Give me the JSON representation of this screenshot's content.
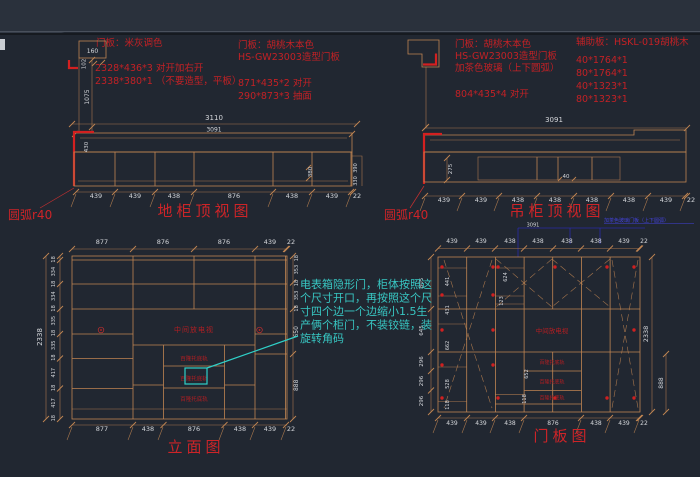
{
  "colors": {
    "background": "#212731",
    "topbar": "#2a313c",
    "line_tan": "#c08552",
    "red": "#c42125",
    "dim_text": "#d5d7db",
    "cyan": "#38c7c3",
    "blue_watermark": "#4343dc"
  },
  "notes": {
    "left": {
      "l1": "门板：米灰调色",
      "l2": "2328*436*3  对开加右开",
      "l3": "2338*380*1 （不要造型，平板）"
    },
    "mid": {
      "l1": "门板：胡桃木本色",
      "l2": "HS-GW23003造型门板",
      "l3": "871*435*2  对开",
      "l4": "290*873*3  抽面"
    },
    "right": {
      "l1": "门板：胡桃木本色",
      "l2": "HS-GW23003造型门板",
      "l3": "加茶色玻璃（上下圆弧）",
      "l4": "804*435*4  对开"
    },
    "aux": {
      "title": "辅助板：HSKL-019胡桃木",
      "i1": "40*1764*1",
      "i2": "80*1764*1",
      "i3": "40*1323*1",
      "i4": "80*1323*1"
    }
  },
  "base_top": {
    "title": "地柜顶视图",
    "arc_label": "圆弧r40",
    "dim_total": "3110",
    "dim_inner": "3091",
    "dim_depth": "430",
    "dim_380": "380",
    "dim_390": "390",
    "dim_330": "330",
    "detail_w": "160",
    "detail_h": "102",
    "detail_drop": "1075",
    "bottom_dims": [
      "439",
      "439",
      "438",
      "876",
      "438",
      "439",
      "22"
    ]
  },
  "wall_top": {
    "title": "吊柜顶视图",
    "arc_label": "圆弧r40",
    "dim_total": "3091",
    "dim_275": "275",
    "dim_40": "40",
    "bottom_dims": [
      "439",
      "439",
      "438",
      "438",
      "438",
      "438",
      "439",
      "22"
    ]
  },
  "elevation": {
    "title": "立面图",
    "dim_height": "2338",
    "top_dims": [
      "877",
      "876",
      "876",
      "439",
      "22"
    ],
    "bottom_dims": [
      "877",
      "438",
      "876",
      "438",
      "439",
      "22"
    ],
    "left_dims": [
      "18",
      "334",
      "18",
      "334",
      "18",
      "335",
      "18",
      "335",
      "18",
      "417",
      "18",
      "417",
      "18"
    ],
    "right_dims": [
      "18",
      "353",
      "18",
      "353",
      "18",
      "650",
      "888"
    ]
  },
  "door": {
    "title": "门板图",
    "dim_total": "3091",
    "dim_height": "2338",
    "dim_888": "888",
    "top_dims": [
      "439",
      "439",
      "438",
      "438",
      "438",
      "438",
      "439",
      "22"
    ],
    "bottom_dims": [
      "439",
      "439",
      "438",
      "876",
      "438",
      "439",
      "22"
    ],
    "left_dims": [
      "805",
      "645",
      "296",
      "296",
      "296"
    ],
    "inner_left_dims": [
      "441",
      "431",
      "662",
      "528",
      "118"
    ],
    "mid_dims": [
      "624",
      "123",
      "652",
      "118"
    ]
  },
  "labels": {
    "tv": "中间放电视",
    "drawer": "百隆托底轨"
  },
  "callout": {
    "l1": "电表箱隐形门，柜体按照这",
    "l2": "个尺寸开口，再按照这个尺",
    "l3": "寸四个边一个边缩小1.5生",
    "l4": "产俩个柜门，不装铰链，装",
    "l5": "旋转角码"
  },
  "watermark": "加茶色玻璃门板（上下圆弧）"
}
